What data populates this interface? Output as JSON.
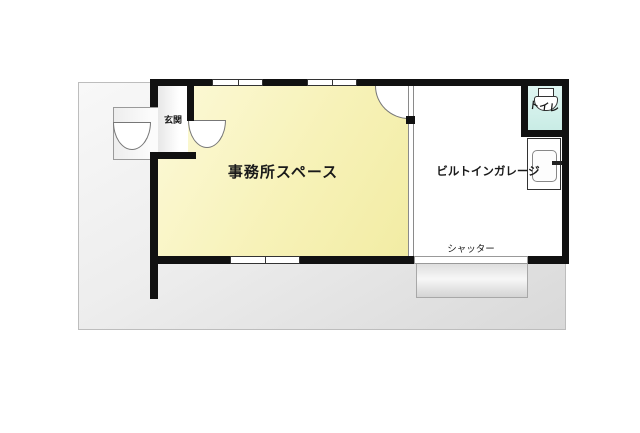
{
  "floorplan": {
    "rooms": {
      "office": {
        "label": "事務所スペース"
      },
      "garage": {
        "label": "ビルトインガレージ"
      },
      "entrance": {
        "label": "玄関"
      },
      "toilet": {
        "label": "トイレ"
      }
    },
    "annotations": {
      "shutter": {
        "label": "シャッター"
      }
    },
    "icons": {
      "toilet_fixture": "toilet-icon",
      "sink_unit": "sink-icon",
      "door_swings": "door-swing-arc-icon",
      "windows": "window-strip-icon"
    },
    "colors": {
      "wall": "#111111",
      "office_fill": "#f7f2b8",
      "toilet_fill": "#d5f0ea",
      "garage_fill": "#ffffff",
      "lot_fill": "#e9e9e9",
      "outline": "#777777"
    }
  }
}
